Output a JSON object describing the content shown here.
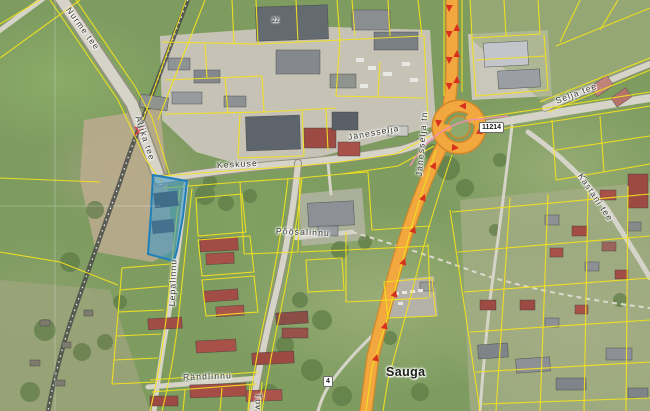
{
  "map": {
    "place_label": "Sauga",
    "house_number": "22",
    "badges": {
      "road_number_east": "11214",
      "road_number_south": "4"
    },
    "streets": {
      "keskuse": "Keskuse",
      "janesselja": "Jänesselja",
      "janesselja_tn": "Jänesselja tn",
      "selja_tee": "Selja tee",
      "kastani_tee": "Kastani tee",
      "poosalinnu": "Põõsalinnu",
      "lepalinnu": "Lepalinnu",
      "randlinnu": "Rändlinnu",
      "allika_tee": "Allika tee",
      "nurme_tee": "Nurme tee",
      "tuvi": "Tuvi"
    },
    "icons": {
      "direction_arrow": "red-arrow-icon",
      "level_crossing": "level-crossing-icon",
      "railway": "railway-line",
      "selected_parcel": "highlighted-cadastral-parcel"
    },
    "colors": {
      "parcel_line": "#f2e020",
      "selection_fill": "#3a98cc",
      "selection_stroke": "#1f7fb8",
      "highway_fill": "#f2a73f",
      "highway_casing": "#d2882a",
      "arrow_red": "#d8301c",
      "road_fill": "#d6d3c8",
      "label_color": "#35352e",
      "pink_line": "#ef8fb4"
    }
  }
}
